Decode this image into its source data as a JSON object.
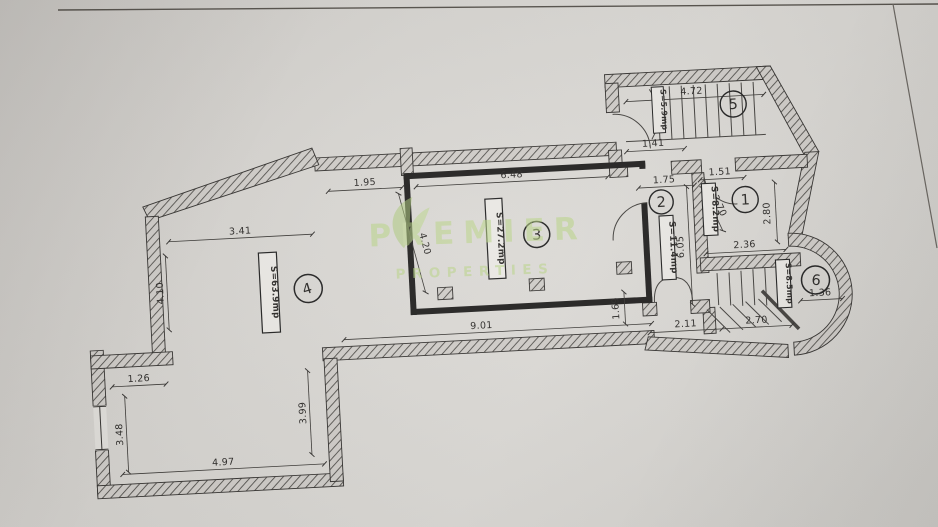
{
  "watermark": {
    "line1": "PREMIER",
    "line2": "PROPERTIES",
    "color": "#b8d584"
  },
  "rooms": {
    "r1": {
      "number": "1",
      "area": "S=8.2mp"
    },
    "r2": {
      "number": "2",
      "area": "S=11.4mp"
    },
    "r3": {
      "number": "3",
      "area": "S=27.2mp"
    },
    "r4": {
      "number": "4",
      "area": "S=63.9mp"
    },
    "r5": {
      "number": "5",
      "area": "S=5.9mp"
    },
    "r6": {
      "number": "6",
      "area": "S=8.5mp"
    }
  },
  "dimensions": {
    "top_left": "1.95",
    "top_main": "6.48",
    "upper_left": "3.41",
    "left_vertical": "4.10",
    "room3_left": "4.20",
    "bl_notch": "1.26",
    "bl_left": "3.48",
    "bl_bottom": "4.97",
    "bl_right": "3.99",
    "hall_bottom": "9.01",
    "exit_step": "1.69",
    "lobby_left": "2.11",
    "lobby_right": "2.70",
    "stair_hall": "1.41",
    "stairs_width": "4.72",
    "room2_top": "1.75",
    "room1_top": "1.51",
    "room1_right": "2.80",
    "room1_bottom": "2.36",
    "room1_diag": "3.70",
    "room2_height": "6.05",
    "bay_width": "1.36"
  }
}
